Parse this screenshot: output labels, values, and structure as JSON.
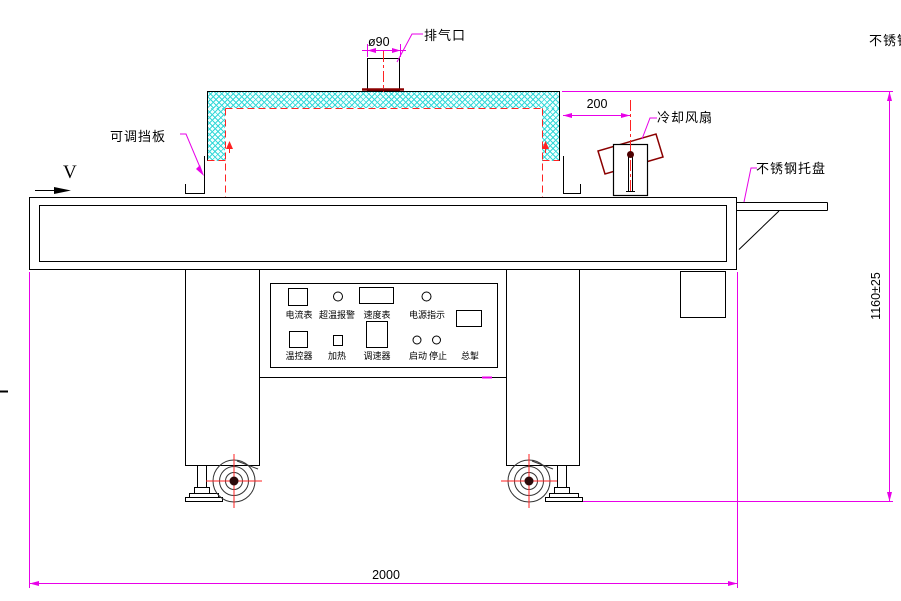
{
  "drawing_title": "tunnel-dryer-front-view",
  "colors": {
    "dimension_magenta": "#e800e8",
    "hidden_line_red": "#ff2222",
    "hatch_cyan": "#35d8d8",
    "weld_dark_red": "#8b0000",
    "outline_black": "#000000"
  },
  "callouts": {
    "exhaust_diameter": "ø90",
    "exhaust_port": "排气口",
    "stainless_top_right": "不锈钢",
    "adjustable_baffle": "可调挡板",
    "cooling_fan": "冷却风扇",
    "stainless_tray": "不锈钢托盘",
    "belt_direction": "V"
  },
  "dimensions": {
    "fan_offset": "200",
    "overall_height": "1160±25",
    "overall_length": "2000"
  },
  "control_panel": {
    "row1": [
      {
        "label": "电流表"
      },
      {
        "label": "超温报警"
      },
      {
        "label": "速度表"
      },
      {
        "label": "电源指示"
      }
    ],
    "row2": [
      {
        "label": "温控器"
      },
      {
        "label": "加热"
      },
      {
        "label": "调速器"
      },
      {
        "label": "启动"
      },
      {
        "label": "停止"
      }
    ],
    "master": {
      "label": "总掣"
    }
  }
}
